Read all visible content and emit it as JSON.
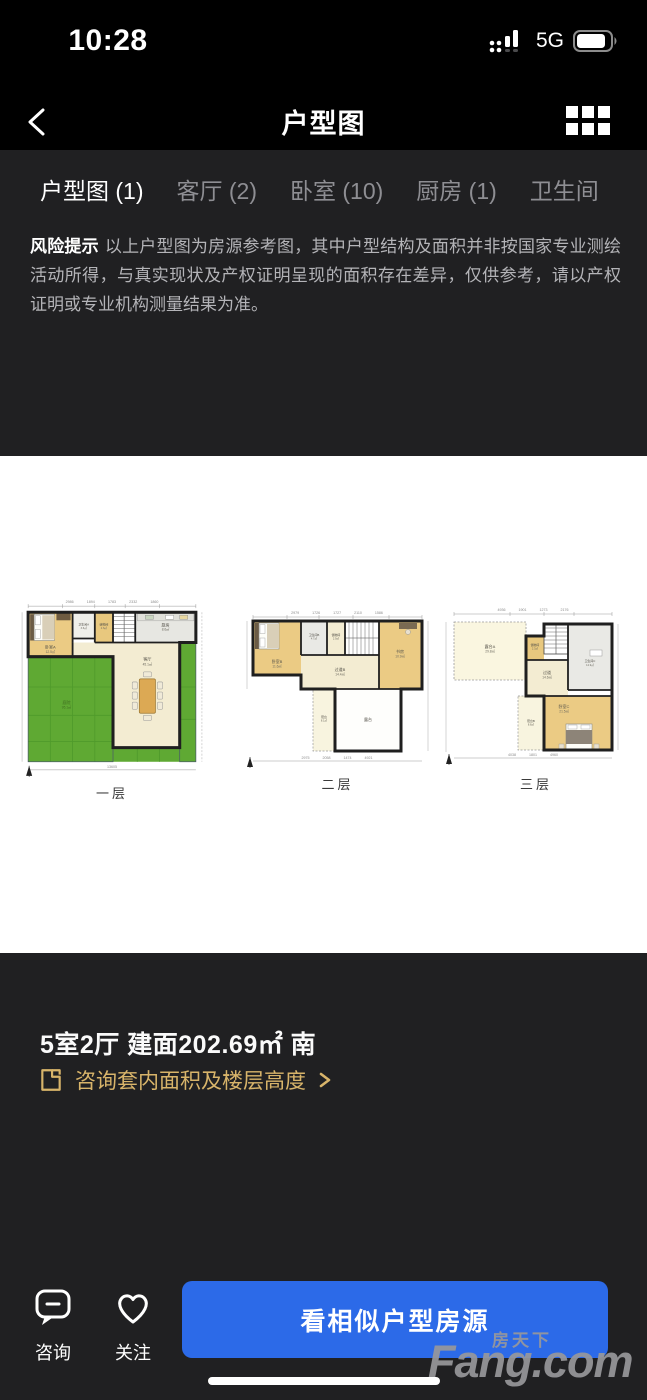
{
  "status_bar": {
    "time": "10:28",
    "network": "5G"
  },
  "header": {
    "title": "户型图"
  },
  "tabs": [
    {
      "label": "户型图 (1)",
      "active": true
    },
    {
      "label": "客厅 (2)",
      "active": false
    },
    {
      "label": "卧室 (10)",
      "active": false
    },
    {
      "label": "厨房 (1)",
      "active": false
    },
    {
      "label": "卫生间",
      "active": false
    }
  ],
  "risk": {
    "label": "风险提示",
    "text": "以上户型图为房源参考图，其中户型结构及面积并非按国家专业测绘活动所得，与真实现状及产权证明呈现的面积存在差异，仅供参考，请以产权证明或专业机构测量结果为准。"
  },
  "floorplans": {
    "floors": [
      {
        "caption": "一层",
        "dim_top": "2986 1894 1783 2332 1860",
        "dim_bottom": "13605",
        "rooms": {
          "bedroom": {
            "name": "卧室A",
            "area": "12.5㎡"
          },
          "bath": {
            "name": "卫生间A",
            "area": "3.6㎡"
          },
          "storage": {
            "name": "储物间",
            "area": "2.6㎡"
          },
          "kitchen": {
            "name": "厨房",
            "area": "8.6㎡"
          },
          "living": {
            "name": "客厅",
            "area": "45.1㎡"
          },
          "yard": {
            "name": "庭院",
            "area": "95.1㎡"
          }
        }
      },
      {
        "caption": "二层",
        "dim_top": "2979 1726 1727 2110 1586",
        "dim_bottom": "2975 2058 1474 4921",
        "rooms": {
          "bedroom": {
            "name": "卧室B",
            "area": "11.6㎡"
          },
          "bath": {
            "name": "卫生间B",
            "area": "4.7㎡"
          },
          "closet": {
            "name": "储物间",
            "area": "2.9㎡"
          },
          "study": {
            "name": "书房",
            "area": "10.9㎡"
          },
          "hall": {
            "name": "过道B",
            "area": "14.4㎡"
          },
          "balcony": {
            "name": "阳台",
            "area": "8.1㎡"
          },
          "terrace": {
            "name": "露台",
            "area": ""
          }
        }
      },
      {
        "caption": "三层",
        "dim_top": "4936 1901 1273 2176",
        "dim_bottom": "4038 1801 4960",
        "rooms": {
          "terrace": {
            "name": "露台A",
            "area": "29.8㎡"
          },
          "storage": {
            "name": "储物间",
            "area": "2.3㎡"
          },
          "bath": {
            "name": "卫生间C",
            "area": "12.9㎡"
          },
          "hall": {
            "name": "过道",
            "area": "14.6㎡"
          },
          "balcony": {
            "name": "阳台B",
            "area": "8.8㎡"
          },
          "bedroom": {
            "name": "卧室C",
            "area": "21.5㎡"
          }
        }
      }
    ]
  },
  "property": {
    "summary": "5室2厅 建面202.69㎡ 南",
    "consult_link": "咨询套内面积及楼层高度"
  },
  "bottom_bar": {
    "consult": "咨询",
    "follow": "关注",
    "cta": "看相似户型房源"
  },
  "watermark": {
    "cn": "房天下",
    "en": "Fang.com"
  },
  "colors": {
    "accent_blue": "#2C6AE8",
    "accent_gold": "#D8B46A",
    "panel_dark": "#202022",
    "plan_green": "#5FA933",
    "plan_tan": "#EBCB84",
    "plan_cream": "#F3ECD2"
  }
}
